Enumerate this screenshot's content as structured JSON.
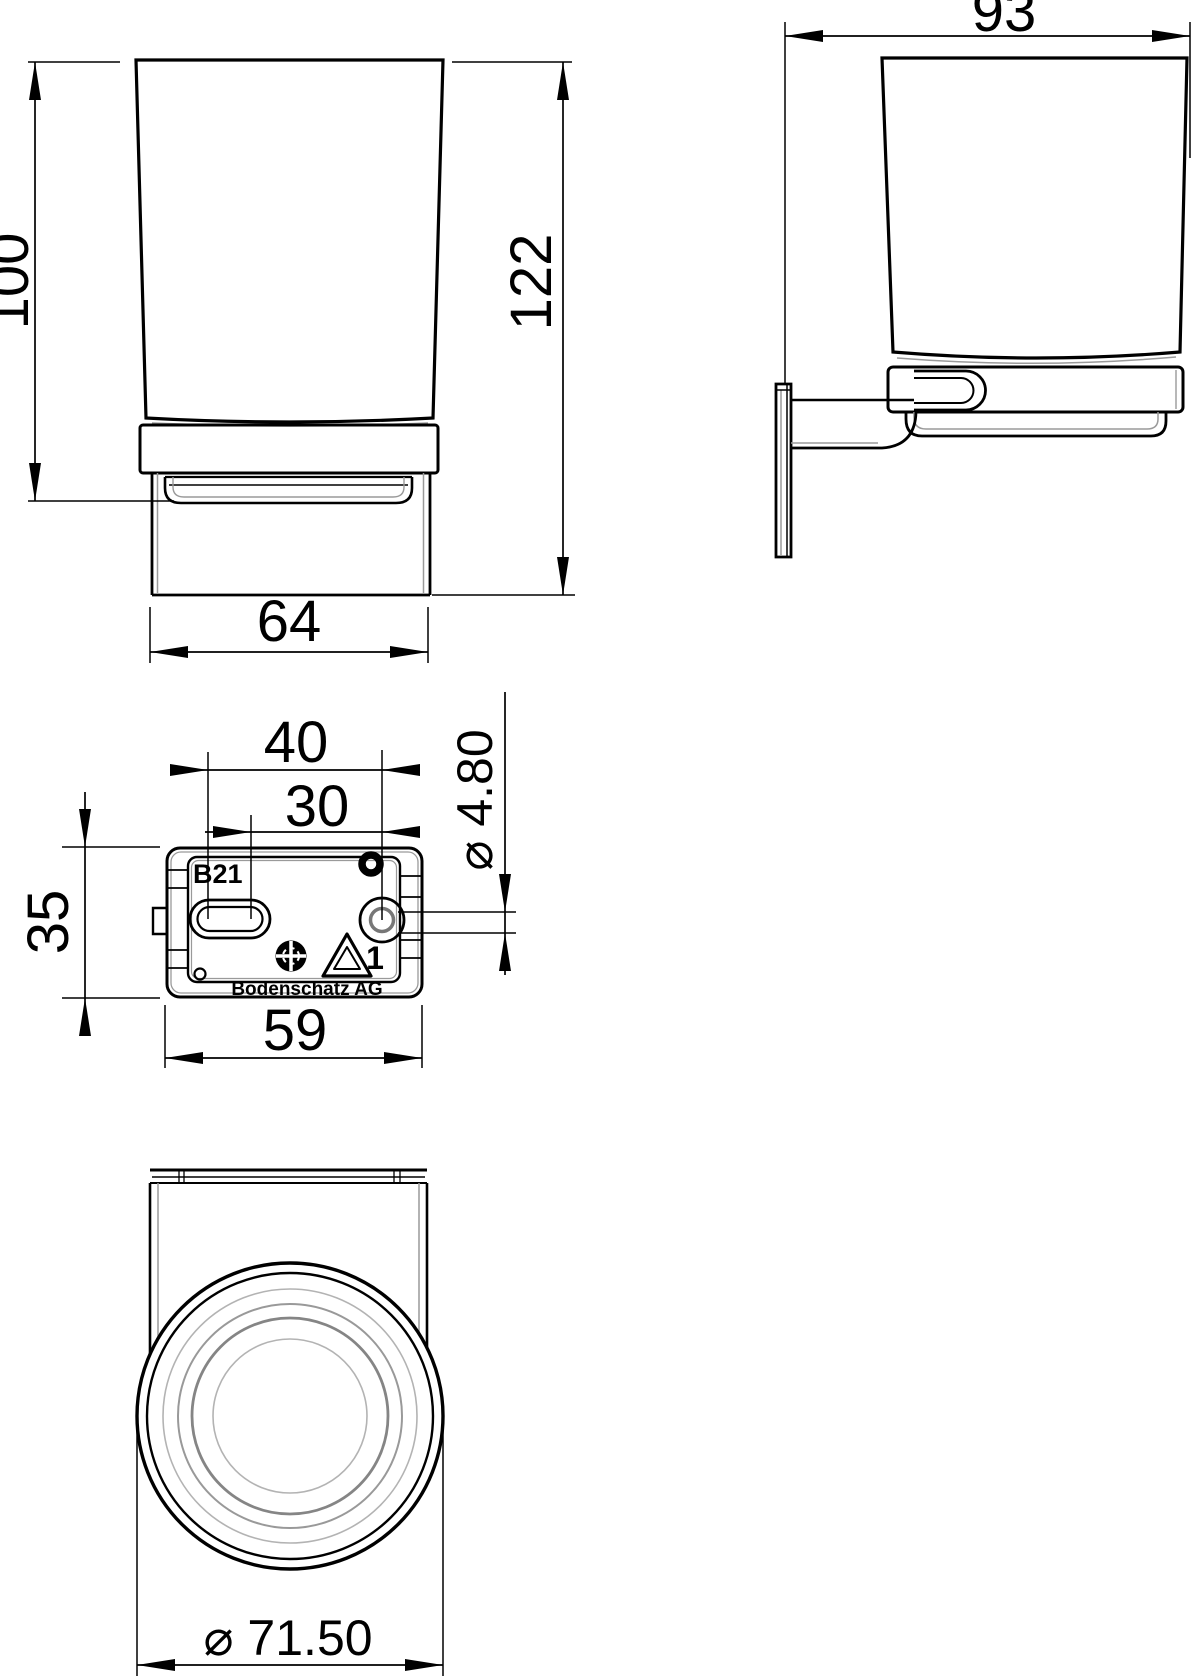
{
  "drawing": {
    "front_view": {
      "dim_glass_height": "100",
      "dim_total_height": "122",
      "dim_holder_width": "64"
    },
    "side_view": {
      "dim_depth": "93"
    },
    "plate_view": {
      "dim_slot_left_to_hole": "40",
      "dim_slot_right_to_hole": "30",
      "dim_plate_height": "35",
      "dim_plate_width": "59",
      "dim_screw_hole_dia": "⌀ 4.80",
      "marking_code": "B21",
      "marking_mold_no": "1",
      "marking_brand": "Bodenschatz AG"
    },
    "bottom_view": {
      "dim_glass_dia": "⌀ 71.50"
    }
  }
}
